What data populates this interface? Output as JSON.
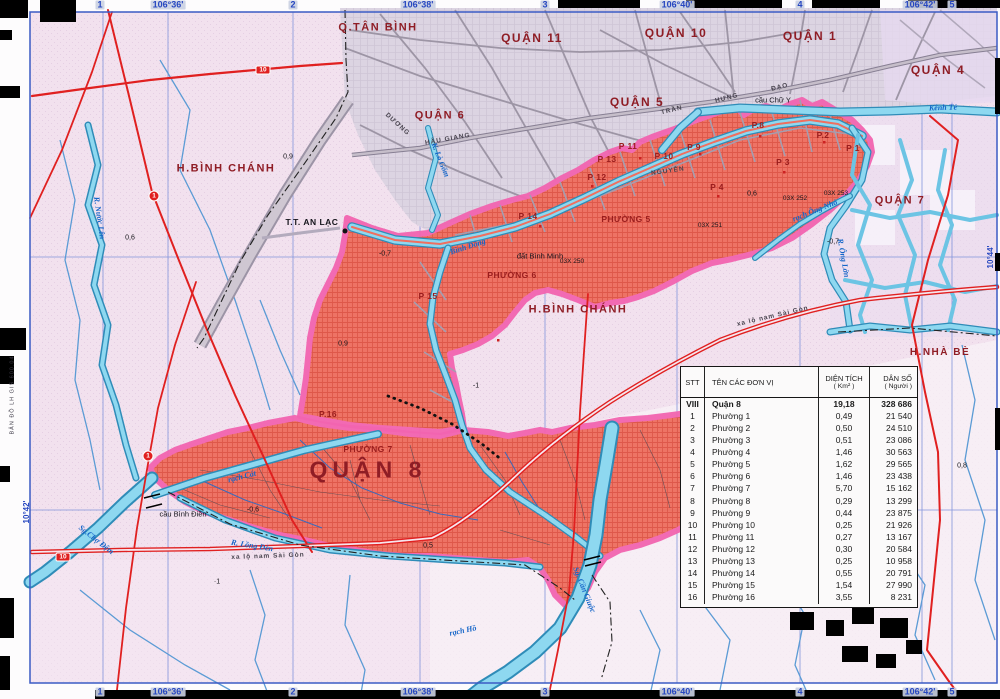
{
  "map": {
    "colors": {
      "district_fill": "#ee6e5e",
      "district_border": "#f264b0",
      "water_fill": "#8ed8f0",
      "water_edge": "#2f8cb8",
      "road_red": "#e02020",
      "urban_gray": "#d9d1dd",
      "background_pink": "#f2e1ee",
      "label_maroon": "#8f1d25",
      "coordinate_blue": "#2747c0"
    },
    "district_labels": [
      {
        "t": "Q.TÂN BÌNH",
        "x": 378,
        "y": 28,
        "s": 11
      },
      {
        "t": "QUẬN 11",
        "x": 532,
        "y": 38,
        "s": 12
      },
      {
        "t": "QUẬN 10",
        "x": 676,
        "y": 33,
        "s": 12
      },
      {
        "t": "QUẬN 1",
        "x": 810,
        "y": 36,
        "s": 12
      },
      {
        "t": "QUẬN 4",
        "x": 938,
        "y": 70,
        "s": 12
      },
      {
        "t": "QUẬN 5",
        "x": 637,
        "y": 102,
        "s": 12
      },
      {
        "t": "QUẬN 6",
        "x": 440,
        "y": 116,
        "s": 11
      },
      {
        "t": "H.BÌNH CHÁNH",
        "x": 226,
        "y": 169,
        "s": 11
      },
      {
        "t": "H.BÌNH CHÁNH",
        "x": 578,
        "y": 310,
        "s": 11
      },
      {
        "t": "QUẬN 7",
        "x": 900,
        "y": 201,
        "s": 11
      },
      {
        "t": "H.NHÀ BÈ",
        "x": 940,
        "y": 353,
        "s": 10
      },
      {
        "t": "QUẬN 8",
        "x": 368,
        "y": 470,
        "s": 23,
        "ls": 5
      }
    ],
    "town_labels": [
      {
        "t": "T.T. AN LẠC",
        "x": 312,
        "y": 222
      }
    ],
    "ward_labels": [
      {
        "t": "P 1",
        "x": 853,
        "y": 148
      },
      {
        "t": "P.2",
        "x": 823,
        "y": 135
      },
      {
        "t": "P 3",
        "x": 783,
        "y": 162
      },
      {
        "t": "P 4",
        "x": 717,
        "y": 187
      },
      {
        "t": "P.8",
        "x": 758,
        "y": 125
      },
      {
        "t": "P 9",
        "x": 694,
        "y": 147
      },
      {
        "t": "P 10",
        "x": 664,
        "y": 156
      },
      {
        "t": "P 11",
        "x": 628,
        "y": 146
      },
      {
        "t": "P 13",
        "x": 607,
        "y": 159
      },
      {
        "t": "P 12",
        "x": 597,
        "y": 177
      },
      {
        "t": "P 14",
        "x": 528,
        "y": 216
      },
      {
        "t": "P 15",
        "x": 428,
        "y": 296
      },
      {
        "t": "P.16",
        "x": 328,
        "y": 414
      },
      {
        "t": "PHƯỜNG 5",
        "x": 626,
        "y": 219
      },
      {
        "t": "PHƯỜNG 6",
        "x": 512,
        "y": 275
      },
      {
        "t": "PHƯỜNG 7",
        "x": 368,
        "y": 449
      }
    ],
    "water_labels": [
      {
        "t": "Kênh Tẻ",
        "x": 943,
        "y": 108,
        "r": -2
      },
      {
        "t": "K. Lò Gốm",
        "x": 440,
        "y": 160,
        "r": 68
      },
      {
        "t": "Bình Đông",
        "x": 468,
        "y": 247,
        "r": -18
      },
      {
        "t": "rạch Ông Nhỏ",
        "x": 815,
        "y": 211,
        "r": -22
      },
      {
        "t": "R. Ông Lớn",
        "x": 843,
        "y": 258,
        "r": 80
      },
      {
        "t": "R. Bà Tàng",
        "x": 714,
        "y": 462,
        "r": 75
      },
      {
        "t": "Sg.Chợ Đệm",
        "x": 96,
        "y": 540,
        "r": 38
      },
      {
        "t": "rạch Cát",
        "x": 242,
        "y": 477,
        "r": -14
      },
      {
        "t": "R. Lồng Đèn",
        "x": 252,
        "y": 546,
        "r": 9
      },
      {
        "t": "Sg. Cần Giuộc",
        "x": 584,
        "y": 590,
        "r": 68
      },
      {
        "t": "rạch Hồ",
        "x": 463,
        "y": 631,
        "r": -12
      },
      {
        "t": "R. Nước Lên",
        "x": 99,
        "y": 218,
        "r": 82
      }
    ],
    "street_labels": [
      {
        "t": "HẬU GIANG",
        "x": 448,
        "y": 140,
        "r": -10
      },
      {
        "t": "TRẦN",
        "x": 672,
        "y": 111,
        "r": -14
      },
      {
        "t": "HƯNG",
        "x": 727,
        "y": 99,
        "r": -14
      },
      {
        "t": "ĐẠO",
        "x": 780,
        "y": 88,
        "r": -14
      },
      {
        "t": "NGUYỄN",
        "x": 668,
        "y": 172,
        "r": -8
      },
      {
        "t": "DƯƠNG",
        "x": 397,
        "y": 125,
        "r": 42
      },
      {
        "t": "xa lộ nam Sài Gòn",
        "x": 268,
        "y": 557,
        "r": -2
      },
      {
        "t": "xa lộ nam Sài Gòn",
        "x": 773,
        "y": 317,
        "r": -13
      }
    ],
    "place_labels": [
      {
        "t": "đất Bình Minh",
        "x": 540,
        "y": 256
      },
      {
        "t": "cầu Chữ Y",
        "x": 773,
        "y": 100
      },
      {
        "t": "cầu Bình Điền",
        "x": 183,
        "y": 514
      }
    ],
    "spot_heights": [
      {
        "t": "0,9",
        "x": 288,
        "y": 157
      },
      {
        "t": "-0,7",
        "x": 385,
        "y": 254
      },
      {
        "t": "0,6",
        "x": 130,
        "y": 238
      },
      {
        "t": "0,9",
        "x": 343,
        "y": 344
      },
      {
        "t": "0,6",
        "x": 752,
        "y": 194
      },
      {
        "t": "-0,7",
        "x": 833,
        "y": 242
      },
      {
        "t": "-0,6",
        "x": 253,
        "y": 510
      },
      {
        "t": "·1",
        "x": 217,
        "y": 582
      },
      {
        "t": "-1",
        "x": 476,
        "y": 386
      },
      {
        "t": "0,5",
        "x": 428,
        "y": 546
      },
      {
        "t": "0,8",
        "x": 962,
        "y": 466
      }
    ],
    "benchmarks": [
      {
        "t": "03X 250",
        "x": 572,
        "y": 262
      },
      {
        "t": "03X 251",
        "x": 710,
        "y": 226
      },
      {
        "t": "03X 252",
        "x": 795,
        "y": 199
      },
      {
        "t": "03X 253",
        "x": 836,
        "y": 194
      }
    ],
    "coords_top": [
      {
        "t": "1",
        "x": 100,
        "y": 5
      },
      {
        "t": "106°36'",
        "x": 168,
        "y": 5
      },
      {
        "t": "2",
        "x": 293,
        "y": 5
      },
      {
        "t": "106°38'",
        "x": 418,
        "y": 5
      },
      {
        "t": "3",
        "x": 545,
        "y": 5
      },
      {
        "t": "106°40'",
        "x": 677,
        "y": 5
      },
      {
        "t": "4",
        "x": 800,
        "y": 5
      },
      {
        "t": "106°42'",
        "x": 920,
        "y": 5
      },
      {
        "t": "5",
        "x": 952,
        "y": 5
      }
    ],
    "coords_bottom": [
      {
        "t": "1",
        "x": 100,
        "y": 692
      },
      {
        "t": "106°36'",
        "x": 168,
        "y": 692
      },
      {
        "t": "2",
        "x": 293,
        "y": 692
      },
      {
        "t": "106°38'",
        "x": 418,
        "y": 692
      },
      {
        "t": "3",
        "x": 545,
        "y": 692
      },
      {
        "t": "106°40'",
        "x": 677,
        "y": 692
      },
      {
        "t": "4",
        "x": 800,
        "y": 692
      },
      {
        "t": "106°42'",
        "x": 920,
        "y": 692
      },
      {
        "t": "5",
        "x": 952,
        "y": 692
      }
    ],
    "edge_labels": [
      {
        "t": "10°42'",
        "x": 27,
        "y": 512,
        "r": -90
      },
      {
        "t": "10°44'",
        "x": 991,
        "y": 257,
        "r": -90
      }
    ],
    "margin_notes": [
      {
        "t": "BẢN ĐỒ LH GIS 600.04",
        "x": 13,
        "y": 395,
        "r": -90
      }
    ],
    "road_badges": [
      {
        "t": "10",
        "shape": "rect",
        "x": 263,
        "y": 70
      },
      {
        "t": "1",
        "shape": "circle",
        "x": 154,
        "y": 196
      },
      {
        "t": "1",
        "shape": "circle",
        "x": 148,
        "y": 456
      },
      {
        "t": "10",
        "shape": "rect",
        "x": 63,
        "y": 557
      }
    ]
  },
  "table": {
    "headers": {
      "stt": "STT",
      "name": "TÊN CÁC ĐƠN VỊ",
      "area1": "DIỆN TÍCH",
      "area2": "( Km² )",
      "pop1": "DÂN SỐ",
      "pop2": "( Người )"
    },
    "rows": [
      {
        "stt": "VIII",
        "name": "Quận 8",
        "area": "19,18",
        "pop": "328 686",
        "bold": true
      },
      {
        "stt": "1",
        "name": "Phường 1",
        "area": "0,49",
        "pop": "21 540"
      },
      {
        "stt": "2",
        "name": "Phường 2",
        "area": "0,50",
        "pop": "24 510"
      },
      {
        "stt": "3",
        "name": "Phường 3",
        "area": "0,51",
        "pop": "23 086"
      },
      {
        "stt": "4",
        "name": "Phường 4",
        "area": "1,46",
        "pop": "30 563"
      },
      {
        "stt": "5",
        "name": "Phường 5",
        "area": "1,62",
        "pop": "29 565"
      },
      {
        "stt": "6",
        "name": "Phường 6",
        "area": "1,46",
        "pop": "23 438"
      },
      {
        "stt": "7",
        "name": "Phường 7",
        "area": "5,70",
        "pop": "15 162"
      },
      {
        "stt": "8",
        "name": "Phường 8",
        "area": "0,29",
        "pop": "13 299"
      },
      {
        "stt": "9",
        "name": "Phường 9",
        "area": "0,44",
        "pop": "23 875"
      },
      {
        "stt": "10",
        "name": "Phường 10",
        "area": "0,25",
        "pop": "21 926"
      },
      {
        "stt": "11",
        "name": "Phường 11",
        "area": "0,27",
        "pop": "13 167"
      },
      {
        "stt": "12",
        "name": "Phường 12",
        "area": "0,30",
        "pop": "20 584"
      },
      {
        "stt": "13",
        "name": "Phường 13",
        "area": "0,25",
        "pop": "10 958"
      },
      {
        "stt": "14",
        "name": "Phường 14",
        "area": "0,55",
        "pop": "20 791"
      },
      {
        "stt": "15",
        "name": "Phường 15",
        "area": "1,54",
        "pop": "27 990"
      },
      {
        "stt": "16",
        "name": "Phường 16",
        "area": "3,55",
        "pop": "8 231"
      }
    ]
  }
}
